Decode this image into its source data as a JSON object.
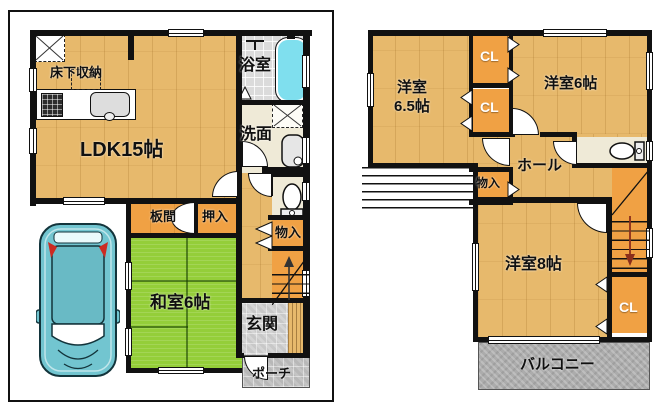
{
  "floor1": {
    "yukashita_label": "床下収納",
    "ldk_label": "LDK15帖",
    "bath_label": "浴室",
    "wash_label": "洗面",
    "itanoma_label": "板間",
    "oshiire_label": "押入",
    "mono_label": "物入",
    "washitsu_label": "和室6帖",
    "genkan_label": "玄関",
    "porch_label": "ポーチ"
  },
  "floor2": {
    "west65_label_line1": "洋室",
    "west65_label_line2": "6.5帖",
    "west6_label": "洋室6帖",
    "cl_top_label": "CL",
    "cl_bottom_label": "CL",
    "hall_label": "ホール",
    "mono_label": "物入",
    "west8_label": "洋室8帖",
    "cl_right_label": "CL",
    "balcony_label": "バルコニー"
  },
  "colors": {
    "wall": "#111111",
    "wood": "#E7B96C",
    "closet": "#F0A144",
    "tatami": "#94CE39",
    "tub": "#7FDFEE",
    "bathtile": "#DBDBDB",
    "cream": "#EFEAD7",
    "genkantile": "#D4D4D4",
    "porchtile": "#C4C4C4",
    "balcony": "#ACACAC",
    "car": "#72C5D0",
    "caraccent": "#CC2B22",
    "arrow": "#8B2E1B"
  }
}
